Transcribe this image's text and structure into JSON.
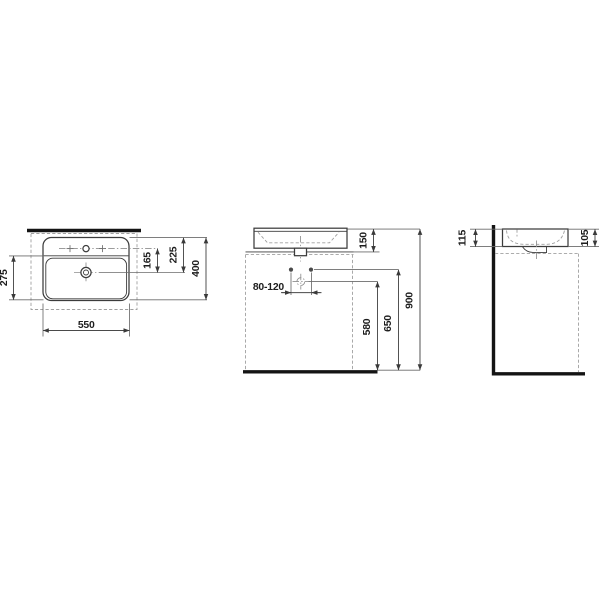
{
  "colors": {
    "background": "#ffffff",
    "line": "#3c3c3c",
    "heavy_line": "#141414",
    "dashed_line": "#a0a0a0",
    "centerline": "#8f8f8f",
    "dimension_text": "#1d1d1d"
  },
  "views": {
    "top": {
      "dims": {
        "basin_width": "550",
        "basin_depth": "400",
        "bowl_to_front": "275",
        "taphole_to_drain": "165",
        "back_to_drain": "225"
      }
    },
    "front": {
      "dims": {
        "rim_above_counter": "150",
        "supply_spacing": "80-120",
        "drain_height": "580",
        "supply_height": "650",
        "rim_height": "900"
      }
    },
    "side": {
      "dims": {
        "back_height": "115",
        "front_height": "105"
      }
    }
  }
}
